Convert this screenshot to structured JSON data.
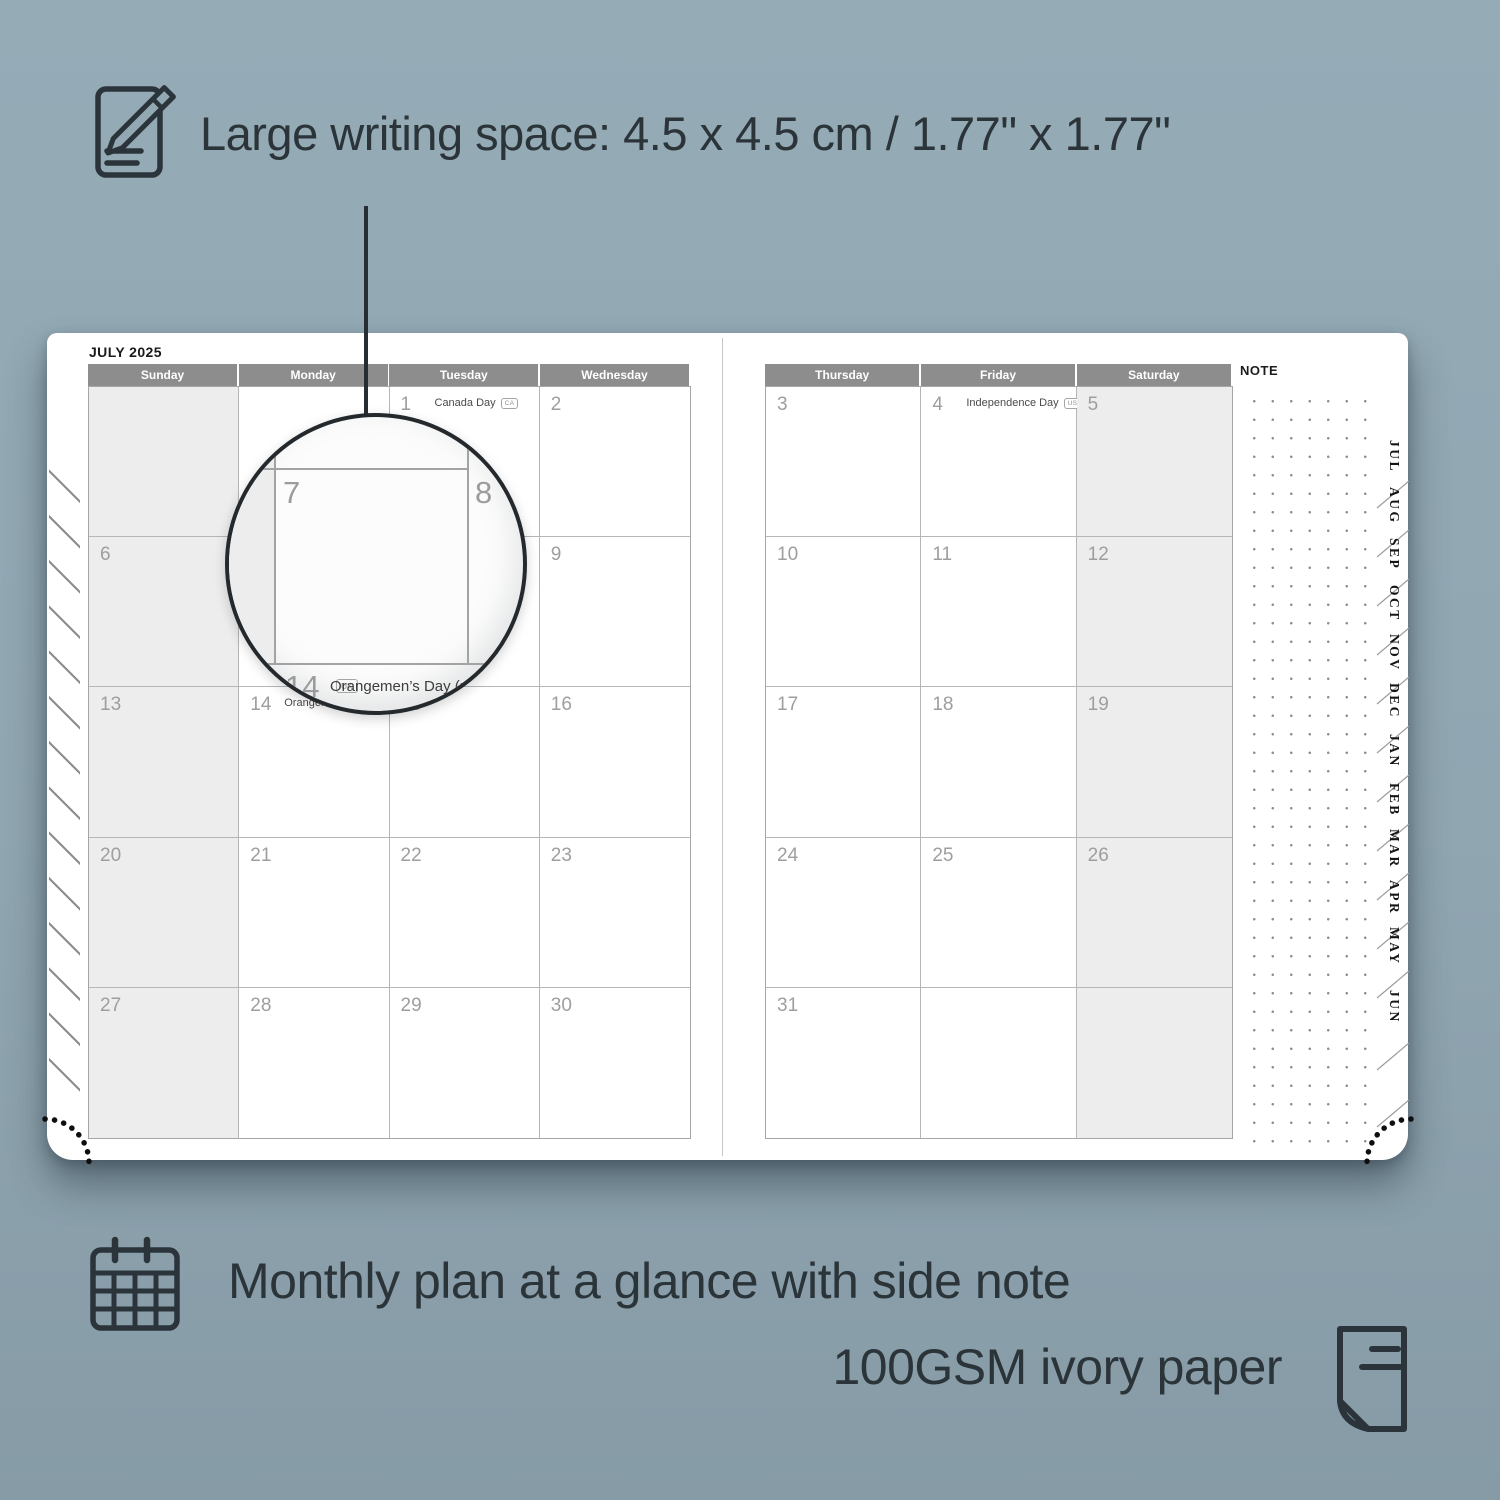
{
  "colors": {
    "background": "#91a8b3",
    "ink": "#2b3439",
    "header_gray": "#8d8d8d",
    "shaded_cell": "#ededed",
    "page": "#ffffff"
  },
  "features": {
    "writing_space": {
      "icon": "notepad-pencil-icon",
      "label": "Large writing space: 4.5 x 4.5 cm / 1.77\" x 1.77\""
    },
    "monthly_plan": {
      "icon": "calendar-grid-icon",
      "label": "Monthly plan at a glance with side note"
    },
    "paper": {
      "icon": "paper-page-icon",
      "label": "100GSM ivory paper"
    }
  },
  "planner": {
    "title": "JULY 2025",
    "note_label": "NOTE",
    "left_page": {
      "day_headers": [
        "Sunday",
        "Monday",
        "Tuesday",
        "Wednesday"
      ],
      "weeks": [
        [
          {
            "d": "",
            "s": 1
          },
          {
            "d": ""
          },
          {
            "d": "1",
            "h": "Canada Day",
            "b": "CA"
          },
          {
            "d": "2"
          }
        ],
        [
          {
            "d": "6",
            "s": 1
          },
          {
            "d": "7"
          },
          {
            "d": "8"
          },
          {
            "d": "9"
          }
        ],
        [
          {
            "d": "13",
            "s": 1
          },
          {
            "d": "14",
            "h": "Orangemen’s Day (n.i.)",
            "b": "UK"
          },
          {
            "d": "15"
          },
          {
            "d": "16"
          }
        ],
        [
          {
            "d": "20",
            "s": 1
          },
          {
            "d": "21"
          },
          {
            "d": "22"
          },
          {
            "d": "23"
          }
        ],
        [
          {
            "d": "27",
            "s": 1
          },
          {
            "d": "28"
          },
          {
            "d": "29"
          },
          {
            "d": "30"
          }
        ]
      ]
    },
    "right_page": {
      "day_headers": [
        "Thursday",
        "Friday",
        "Saturday"
      ],
      "weeks": [
        [
          {
            "d": "3"
          },
          {
            "d": "4",
            "h": "Independence Day",
            "b": "US"
          },
          {
            "d": "5",
            "s": 1
          }
        ],
        [
          {
            "d": "10"
          },
          {
            "d": "11"
          },
          {
            "d": "12",
            "s": 1
          }
        ],
        [
          {
            "d": "17"
          },
          {
            "d": "18"
          },
          {
            "d": "19",
            "s": 1
          }
        ],
        [
          {
            "d": "24"
          },
          {
            "d": "25"
          },
          {
            "d": "26",
            "s": 1
          }
        ],
        [
          {
            "d": "31"
          },
          {
            "d": ""
          },
          {
            "d": "",
            "s": 1
          }
        ]
      ]
    },
    "tabs": [
      "JUL",
      "AUG",
      "SEP",
      "OCT",
      "NOV",
      "DEC",
      "JAN",
      "FEB",
      "MAR",
      "APR",
      "MAY",
      "JUN"
    ],
    "magnifier": {
      "day_main": "7",
      "day_next": "8",
      "day_below": "14",
      "holiday": "Orangemen’s Day (n.i.)",
      "badge": "UK"
    }
  }
}
